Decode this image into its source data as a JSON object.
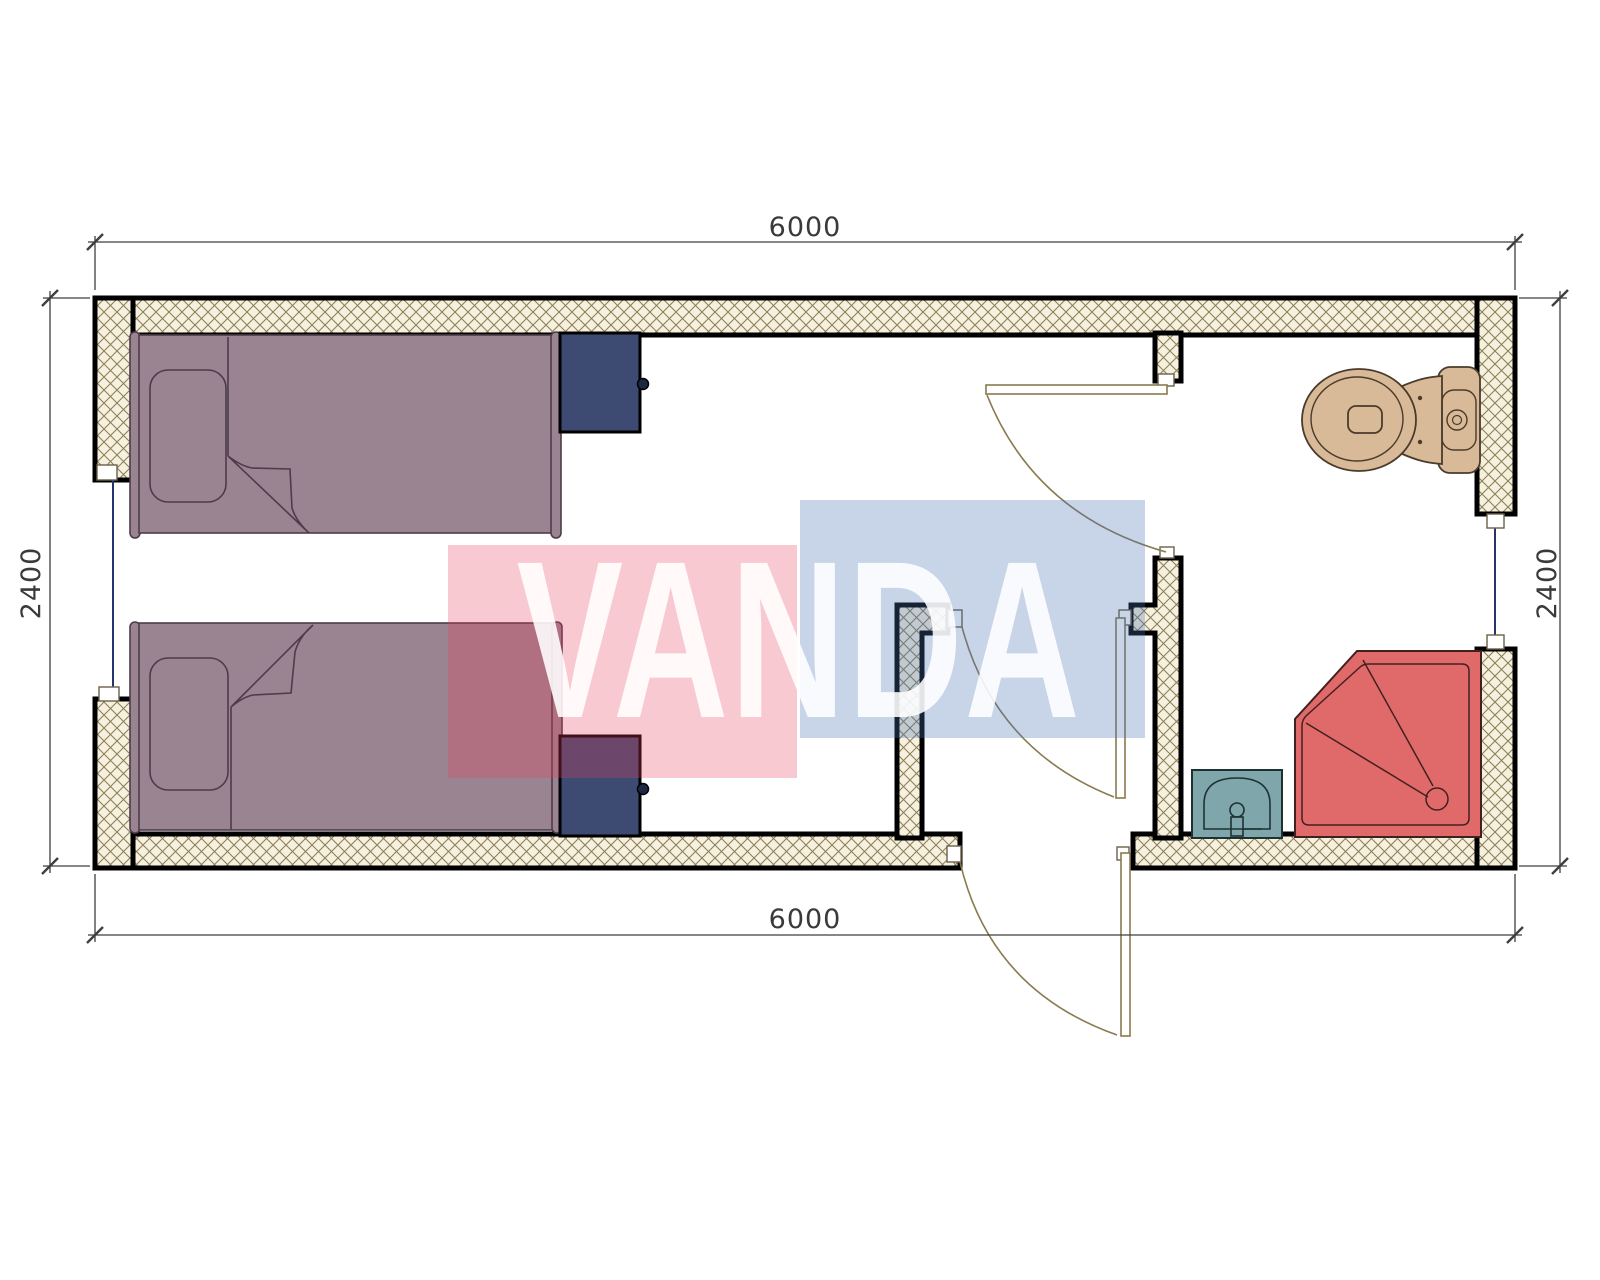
{
  "dimensions": {
    "top_label": "6000",
    "bottom_label": "6000",
    "left_label": "2400",
    "right_label": "2400"
  },
  "watermark": {
    "text": "VANDA",
    "pink_fill": "rgba(231,62,88,0.28)",
    "blue_fill": "rgba(73,113,180,0.30)",
    "text_fill": "rgba(255,255,255,0.88)"
  },
  "colors": {
    "background": "#ffffff",
    "wall_fill": "#f6f1de",
    "wall_hatch_line": "#8e7f58",
    "wall_edge": "#000000",
    "bed_fill": "#9b8492",
    "bed_line": "#4d3c49",
    "nightstand_fill": "#3d4a72",
    "nightstand_knob": "#1c2742",
    "toilet_fill": "#d9ba98",
    "toilet_line": "#4a3b2a",
    "shower_fill": "#e06a6a",
    "shower_line": "#42201f",
    "sink_fill": "#7fa6ab",
    "sink_line": "#1e3132",
    "door_line": "#8a7a50",
    "window_line": "#24356b",
    "dim_line": "#3f3f3f"
  }
}
